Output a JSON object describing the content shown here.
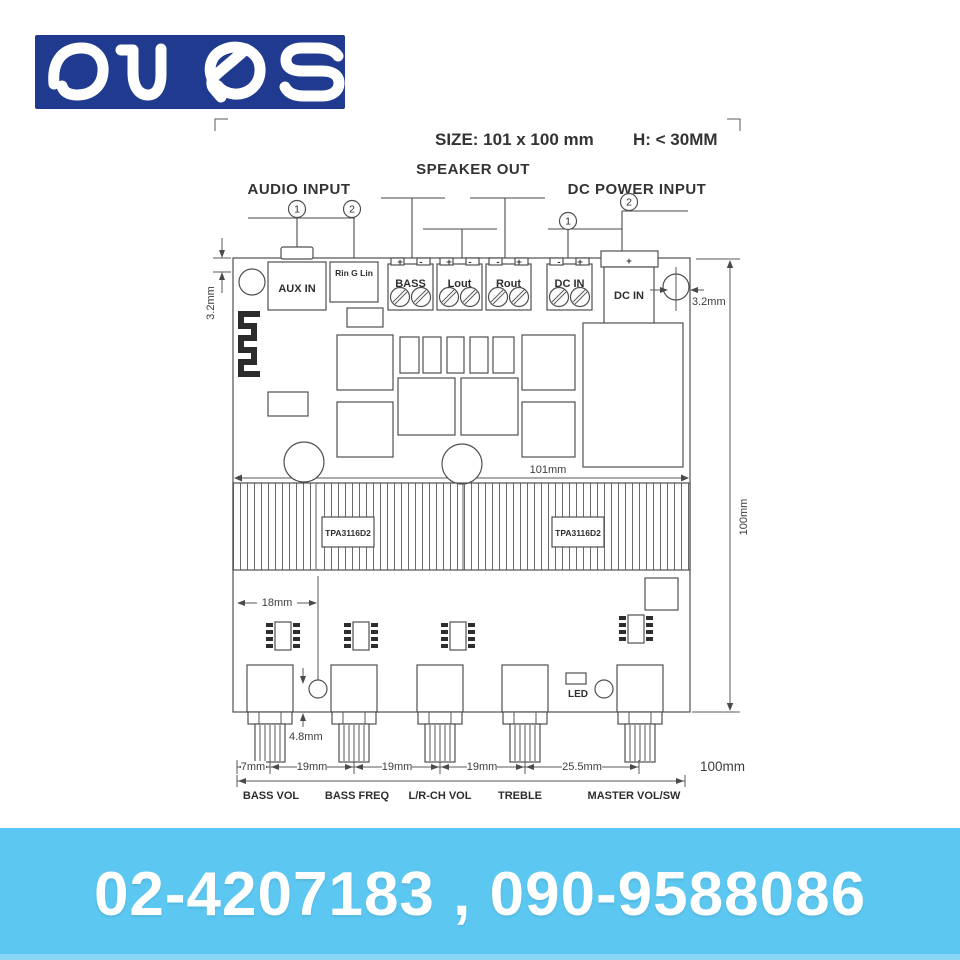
{
  "brand": {
    "name": "OUQS"
  },
  "header": {
    "size_label": "SIZE:  101 x 100 mm",
    "height_label": "H:  < 30MM"
  },
  "annotations": {
    "audio_input": "AUDIO INPUT",
    "speaker_out": "SPEAKER  OUT",
    "dc_power_input": "DC POWER INPUT",
    "marker_1": "1",
    "marker_2": "2"
  },
  "board": {
    "connectors": {
      "aux_in": "AUX IN",
      "line_in": "Rin G Lin",
      "bass": "BASS",
      "lout": "Lout",
      "rout": "Rout",
      "dc_in_terminal": "DC IN",
      "dc_in_jack": "DC IN"
    },
    "signs": {
      "plus": "+",
      "minus": "-"
    },
    "chips": {
      "amp_left": "TPA3116D2",
      "amp_right": "TPA3116D2"
    },
    "led_label": "LED"
  },
  "dimensions": {
    "offset_left": "3.2mm",
    "offset_right": "3.2mm",
    "board_width": "101mm",
    "board_height": "100mm",
    "pot_left_offset": "18mm",
    "shaft_height": "4.8mm",
    "pot_edge_gap": "7mm",
    "pot_spacing": "19mm",
    "pot_spacing_last": "25.5mm",
    "bottom_width": "100mm"
  },
  "controls": {
    "labels": [
      "BASS VOL",
      "BASS FREQ",
      "L/R-CH VOL",
      "TREBLE",
      "MASTER VOL/SW"
    ]
  },
  "footer": {
    "phone": "02-4207183 , 090-9588086"
  },
  "colors": {
    "brand_blue": "#1f3a8e",
    "banner_blue": "#5cc7f1",
    "line_gray": "#4a4a4a"
  }
}
